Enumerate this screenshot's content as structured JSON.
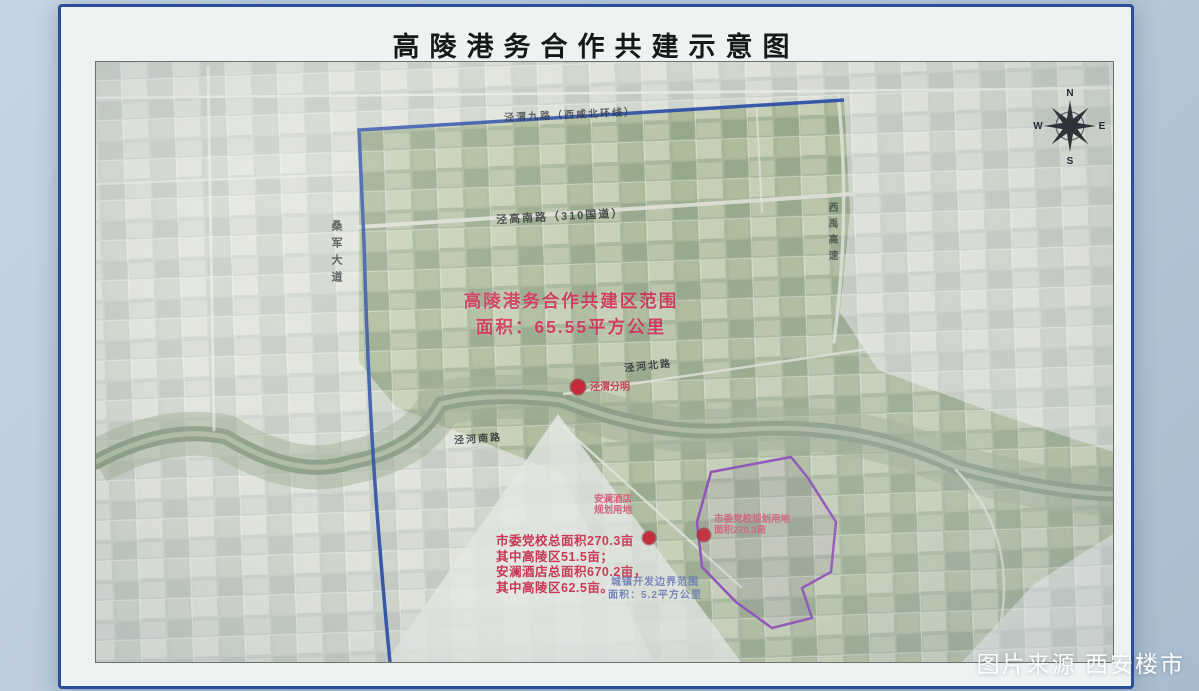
{
  "title": "高陵港务合作共建示意图",
  "watermark": "图片来源 西安楼市",
  "compass": {
    "north": "N",
    "east": "E",
    "south": "S",
    "west": "W"
  },
  "zone_callout": {
    "lines": [
      "高陵港务合作共建区范围",
      "面积：65.55平方公里"
    ]
  },
  "stats_note": {
    "lines": [
      "市委党校总面积270.3亩",
      "其中高陵区51.5亩；",
      "安澜酒店总面积670.2亩，",
      "其中高陵区62.5亩。"
    ]
  },
  "road_labels": {
    "north_boundary_road": "泾渭九路（西咸北环线）",
    "g310_road": "泾高南路（310国道）",
    "sangjun_avenue": "桑军大道",
    "xiyu_expressway": "西禹高速",
    "jinghe_north_road": "泾河北路",
    "jinghe_south_road": "泾河南路"
  },
  "poi_labels": {
    "jingwei_confluence": "泾渭分明",
    "anlan_hotel": {
      "lines": [
        "安澜酒店",
        "规划用地"
      ]
    },
    "party_school": {
      "lines": [
        "市委党校规划用地",
        "面积270.3亩"
      ]
    },
    "development_boundary": {
      "lines": [
        "城镇开发边界范围",
        "面积：5.2平方公里"
      ]
    }
  },
  "colors": {
    "frame_blue": "#2a4e9b",
    "route_blue": "#2a4da6",
    "highlight_red": "#ce224c",
    "boundary_purple": "#8a46b4",
    "board_background": "#b7c8d8"
  }
}
